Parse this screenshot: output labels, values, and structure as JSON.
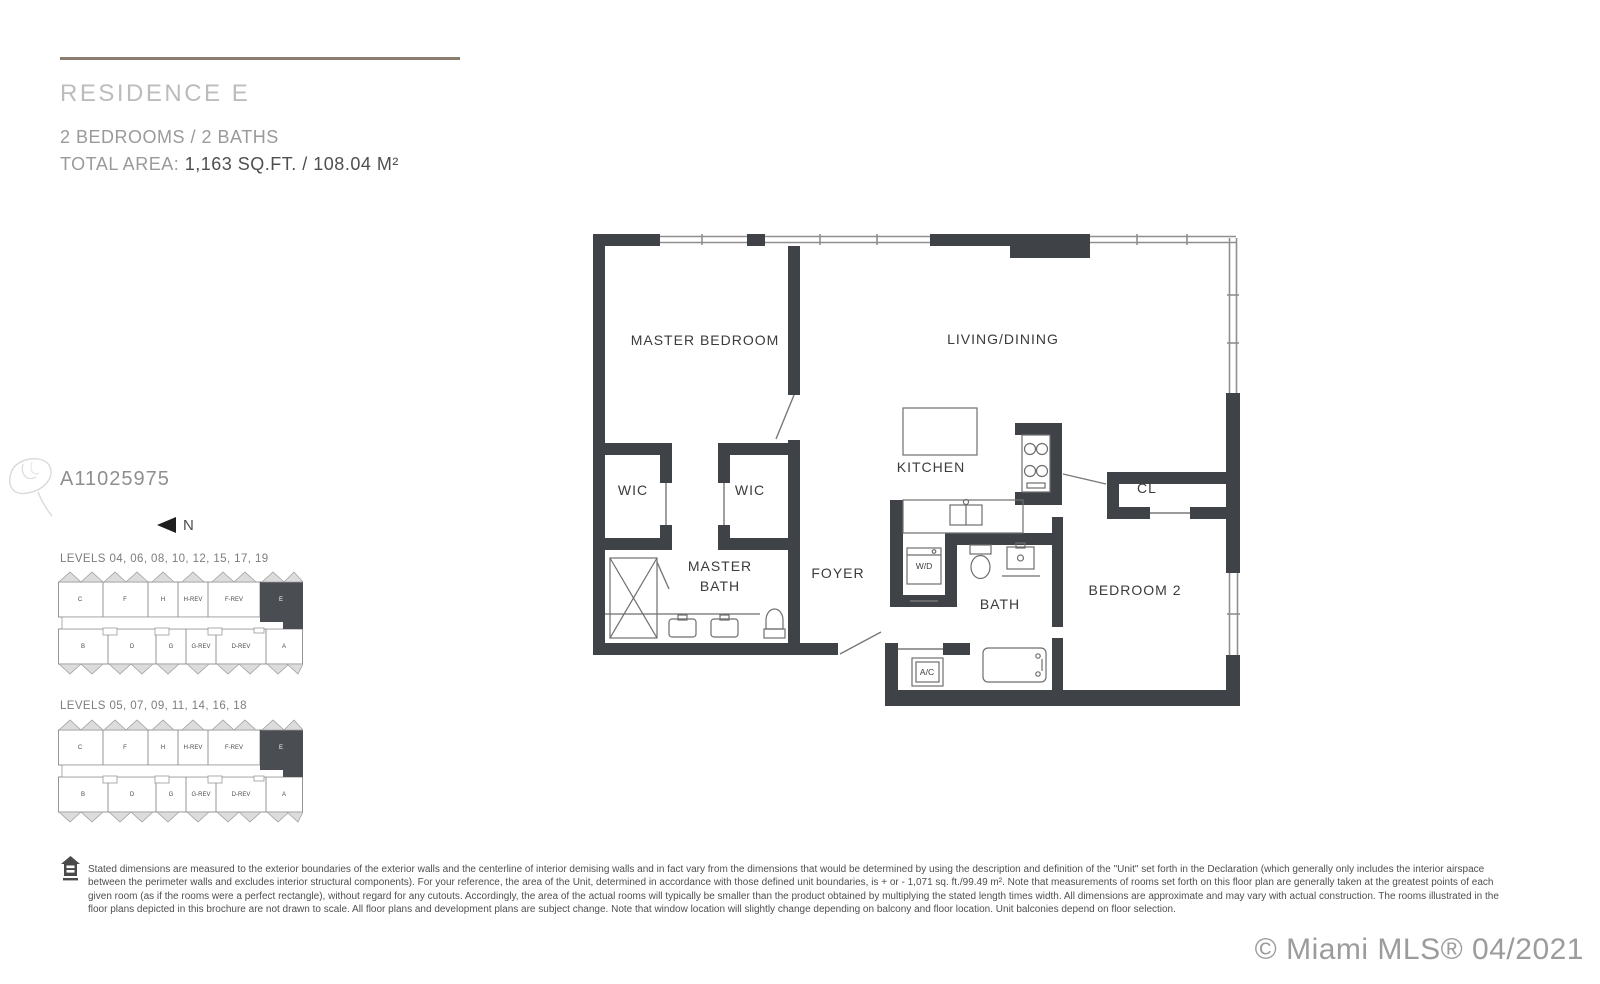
{
  "header": {
    "title": "RESIDENCE E",
    "subtitle": "2 BEDROOMS / 2 BATHS",
    "area_label": "TOTAL AREA:",
    "area_value": "1,163 SQ.FT.  /  108.04 M²"
  },
  "mls_number": "A11025975",
  "north_label": "N",
  "keyplans": [
    {
      "levels": "LEVELS 04, 06, 08, 10, 12, 15, 17, 19",
      "top_units": [
        "C",
        "F",
        "H",
        "H-REV",
        "F-REV",
        "E"
      ],
      "bottom_units": [
        "B",
        "D",
        "G",
        "G-REV",
        "D-REV",
        "A"
      ],
      "highlighted_unit": "E"
    },
    {
      "levels": "LEVELS 05, 07, 09, 11, 14, 16, 18",
      "top_units": [
        "C",
        "F",
        "H",
        "H-REV",
        "F-REV",
        "E"
      ],
      "bottom_units": [
        "B",
        "D",
        "G",
        "G-REV",
        "D-REV",
        "A"
      ],
      "highlighted_unit": "E"
    }
  ],
  "floorplan": {
    "rooms": {
      "master_bedroom": "MASTER BEDROOM",
      "living_dining": "LIVING/DINING",
      "wic": "WIC",
      "kitchen": "KITCHEN",
      "closet": "CL",
      "master_bath_1": "MASTER",
      "master_bath_2": "BATH",
      "foyer": "FOYER",
      "washer_dryer": "W/D",
      "bath": "BATH",
      "bedroom_2": "BEDROOM 2",
      "ac": "A/C"
    }
  },
  "disclaimer": "Stated dimensions are measured to the exterior boundaries of the exterior walls and the centerline of interior demising walls and in fact vary from the dimensions that would be determined by using the description and definition of the \"Unit\" set forth in the Declaration (which generally only includes the interior airspace between the perimeter walls and excludes interior structural components). For your reference, the area of the Unit, determined in accordance with those defined unit boundaries, is + or - 1,071 sq. ft./99.49 m². Note that measurements of rooms set forth on this floor plan are generally taken at the greatest points of each given room (as if the rooms were a perfect rectangle), without regard for any cutouts. Accordingly, the area of the actual rooms will typically be smaller than the product obtained by multiplying the stated length times width. All dimensions are approximate and may vary with actual construction. The rooms illustrated in the floor plans depicted in this brochure are not drawn to scale. All floor plans and development plans are subject change. Note that window location will slightly change depending on balcony and floor location. Unit balconies depend on floor selection.",
  "watermark": "© Miami MLS® 04/2021",
  "colors": {
    "wall": "#3f4347",
    "accent_rule": "#8a7e71",
    "keyplan_highlight": "#4a4e52"
  }
}
